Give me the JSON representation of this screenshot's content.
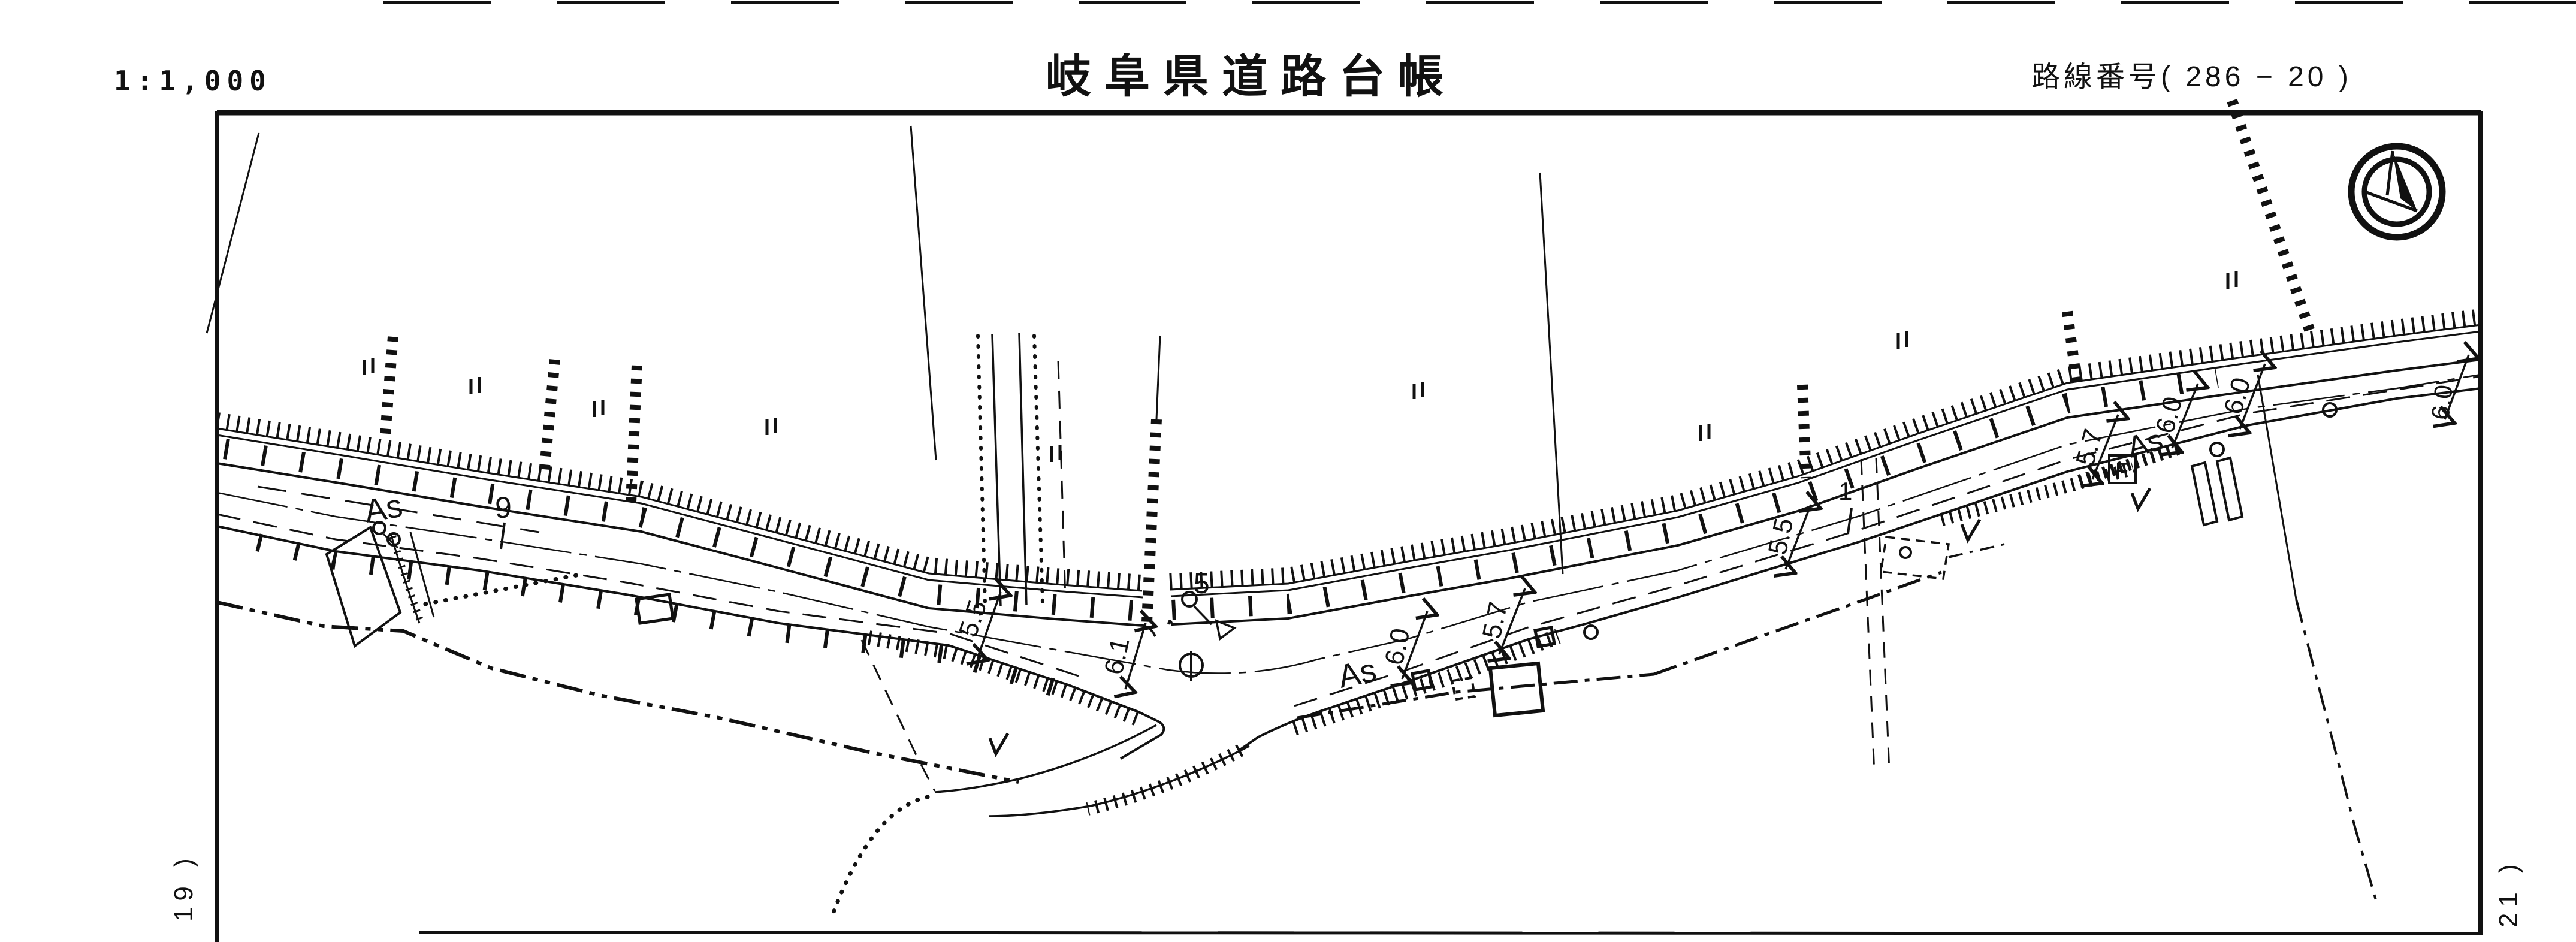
{
  "header": {
    "scale": "1:1,000",
    "title": "岐阜県道路台帳",
    "route_label": "路線番号( 286 − 20 )"
  },
  "margins": {
    "left_sheet_ref": "− 19 )",
    "right_sheet_ref": "− 21 )"
  },
  "icons": {
    "north_arrow": "north-arrow-in-double-circle"
  },
  "colors": {
    "ink": "#111111",
    "paper": "#ffffff"
  },
  "map": {
    "labels": [
      {
        "text": "As",
        "kind": "pavement"
      },
      {
        "text": "9",
        "kind": "station"
      },
      {
        "text": "5.5",
        "kind": "width"
      },
      {
        "text": "6.1",
        "kind": "width"
      },
      {
        "text": "5",
        "kind": "station"
      },
      {
        "text": "As",
        "kind": "pavement"
      },
      {
        "text": "6.0",
        "kind": "width"
      },
      {
        "text": "5.7",
        "kind": "width"
      },
      {
        "text": "5.5",
        "kind": "width"
      },
      {
        "text": "1",
        "kind": "station"
      },
      {
        "text": "5.7",
        "kind": "width"
      },
      {
        "text": "As",
        "kind": "pavement"
      },
      {
        "text": "6.0",
        "kind": "width"
      },
      {
        "text": "6.0",
        "kind": "width"
      },
      {
        "text": "6.0",
        "kind": "width"
      },
      {
        "text": "F",
        "kind": "facility-symbol"
      }
    ]
  }
}
